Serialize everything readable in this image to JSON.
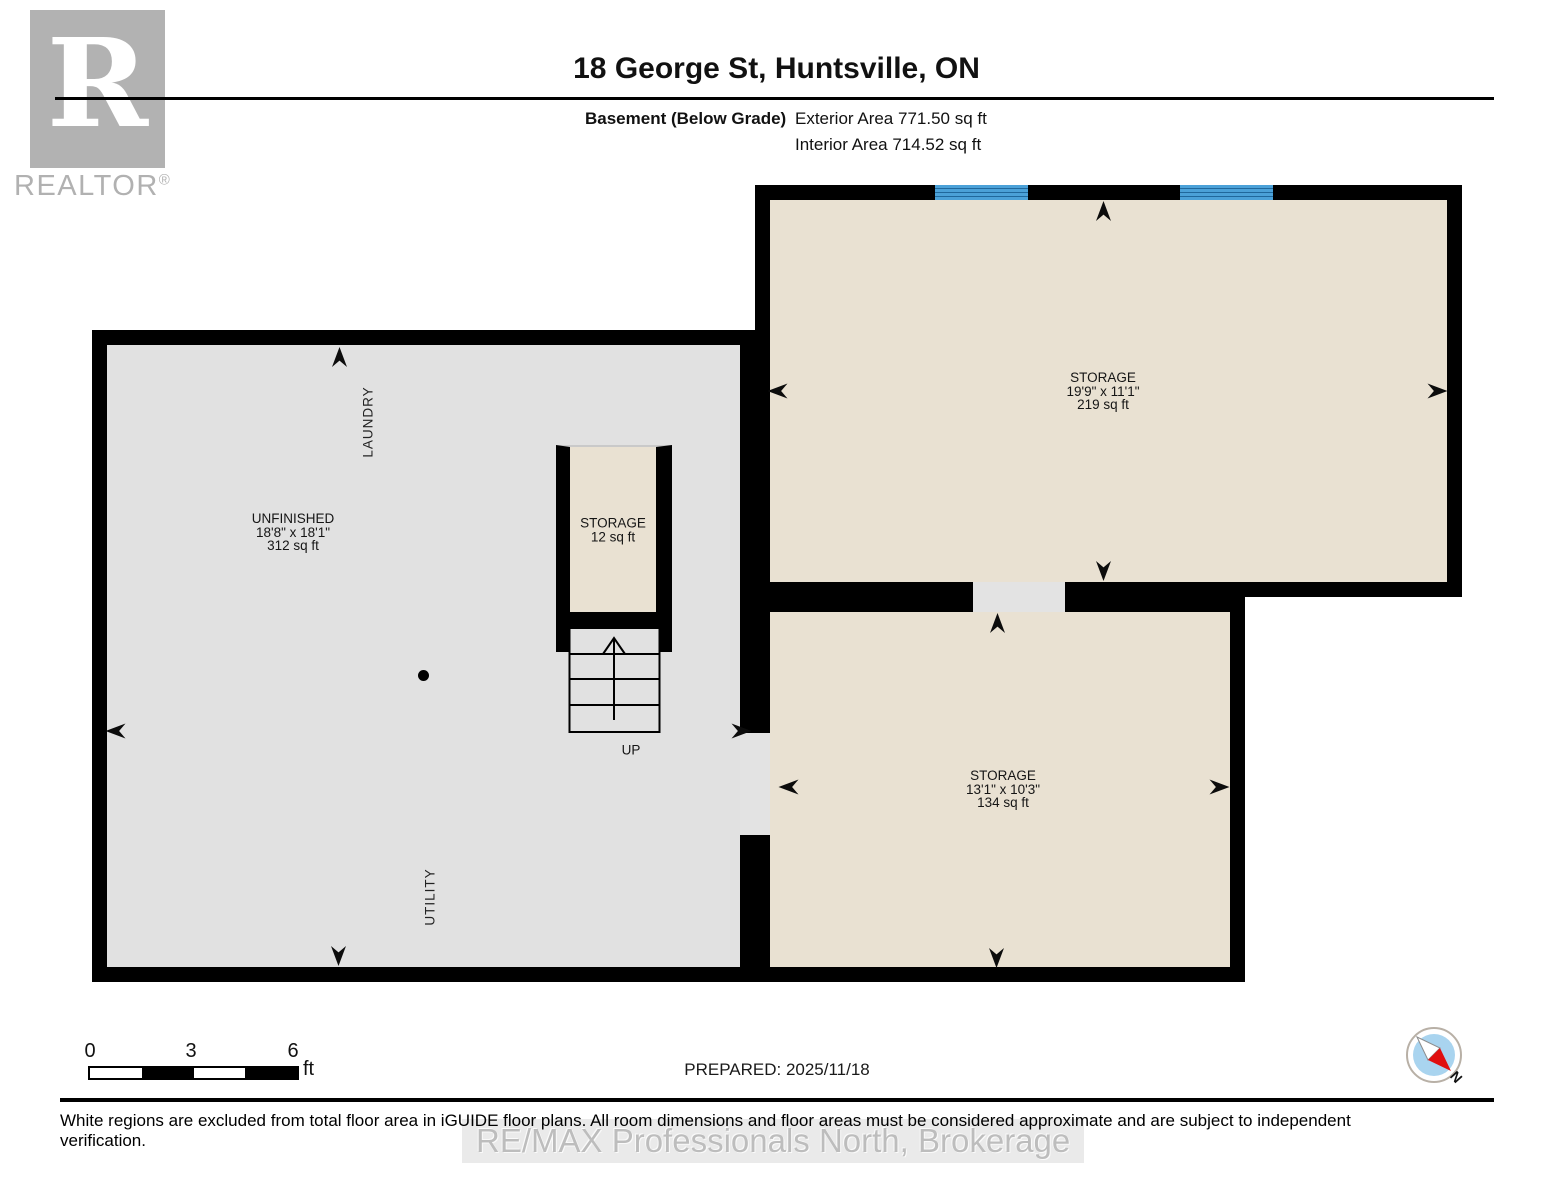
{
  "header": {
    "logo_letter": "R",
    "brand": "REALTOR",
    "brand_reg": "®",
    "title": "18 George St, Huntsville, ON",
    "floor_label": "Basement (Below Grade)",
    "exterior_area": "Exterior Area 771.50 sq ft",
    "interior_area": "Interior Area 714.52 sq ft"
  },
  "plan": {
    "unfinished": {
      "name": "UNFINISHED",
      "dims": "18'8\" x 18'1\"",
      "area": "312 sq ft"
    },
    "laundry_label": "LAUNDRY",
    "utility_label": "UTILITY",
    "storage_large": {
      "name": "STORAGE",
      "dims": "19'9\" x 11'1\"",
      "area": "219 sq ft"
    },
    "storage_small": {
      "name": "STORAGE",
      "dims": "13'1\" x 10'3\"",
      "area": "134 sq ft"
    },
    "storage_closet": {
      "name": "STORAGE",
      "area": "12 sq ft"
    },
    "stairs_label": "UP"
  },
  "footer": {
    "scale_ticks": [
      "0",
      "3",
      "6"
    ],
    "scale_unit": "ft",
    "prepared": "PREPARED: 2025/11/18",
    "north_label": "N",
    "disclaimer": "White regions are excluded from total floor area in iGUIDE floor plans. All room dimensions and floor areas must be considered approximate and are subject to independent verification.",
    "watermark": "RE/MAX Professionals North, Brokerage"
  },
  "colors": {
    "wall": "#000000",
    "room_gray": "#e1e1e1",
    "room_beige": "#e9e1d2",
    "window_blue": "#4ba1d8",
    "logo_gray": "#b2b2b2",
    "compass_blue": "#a9d4ef",
    "compass_red": "#e01010",
    "watermark_gray": "#bdbdbd"
  }
}
